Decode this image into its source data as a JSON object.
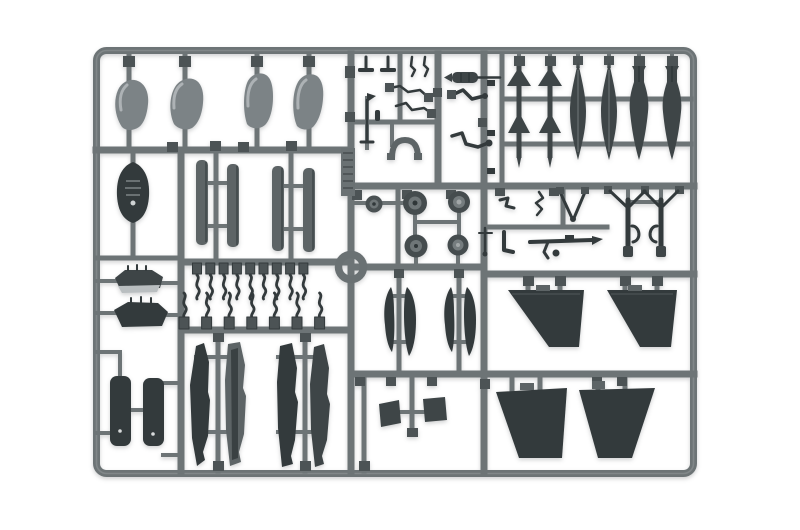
{
  "meta": {
    "description": "Product photograph of a gray injection-molded polystyrene model-kit sprue (parts tree) holding aircraft model parts, shot on a plain white background.",
    "subject": "plastic model kit sprue",
    "visible_text": "none (only an unreadable embossed mold tag on the central runner)"
  },
  "colors": {
    "background": "#ffffff",
    "runner": "#6d7476",
    "runner_light": "#8a9092",
    "part_light": "#7c8386",
    "part_mid": "#5d6466",
    "part_dark": "#3e4547",
    "part_darker": "#333a3c",
    "gate_pad": "#4c5355",
    "hub_light": "#a2a7a8",
    "highlight": "#b9bec0"
  },
  "sprue": {
    "material": "gray polystyrene",
    "frame_bounds": {
      "x": 93,
      "y": 47,
      "width": 604,
      "height": 430
    },
    "part_groups": [
      {
        "name": "canopy shells",
        "count": 4,
        "area": "top left"
      },
      {
        "name": "nose cone",
        "count": 1,
        "area": "left column"
      },
      {
        "name": "slim gear-door blades",
        "count": 4,
        "area": "upper middle-left"
      },
      {
        "name": "fuselage spine fairings",
        "count": 2,
        "area": "left column"
      },
      {
        "name": "S-shaped hinge parts",
        "count": 16,
        "area": "middle-left, two rows"
      },
      {
        "name": "pylon / tank halves",
        "count": 4,
        "area": "lower middle-left"
      },
      {
        "name": "landing gear doors",
        "count": 2,
        "area": "bottom left"
      },
      {
        "name": "cockpit and probe small parts",
        "count": 10,
        "area": "top middle"
      },
      {
        "name": "wheels",
        "count": 5,
        "area": "center"
      },
      {
        "name": "circular ring part",
        "count": 1,
        "area": "center"
      },
      {
        "name": "embossed mold tag",
        "count": 1,
        "area": "central runner"
      },
      {
        "name": "finned missiles",
        "count": 2,
        "area": "top right"
      },
      {
        "name": "drop tanks",
        "count": 2,
        "area": "top right"
      },
      {
        "name": "bombs",
        "count": 2,
        "area": "top right"
      },
      {
        "name": "main landing gear struts",
        "count": 2,
        "area": "middle right"
      },
      {
        "name": "linkage and gun small parts",
        "count": 6,
        "area": "middle right"
      },
      {
        "name": "curved fin blades",
        "count": 4,
        "area": "center bottom"
      },
      {
        "name": "small flaps",
        "count": 2,
        "area": "bottom middle"
      },
      {
        "name": "wing / stabilizer panels",
        "count": 4,
        "area": "bottom right"
      }
    ]
  }
}
